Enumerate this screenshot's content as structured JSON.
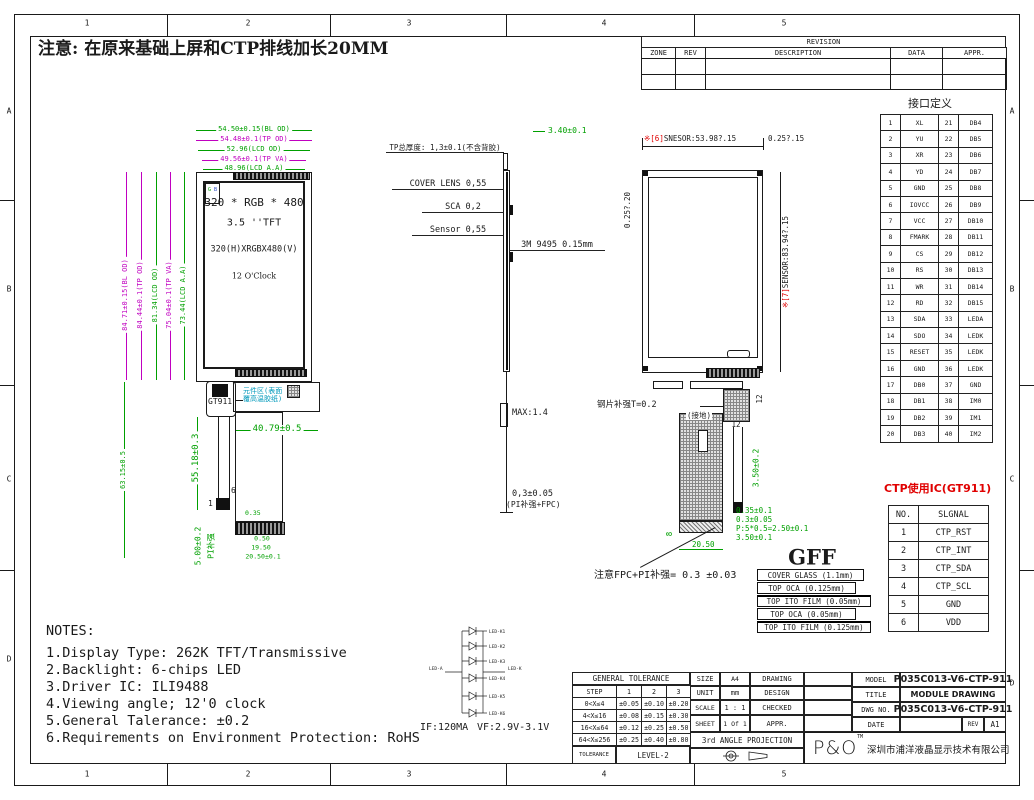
{
  "border": {
    "cols": [
      "1",
      "2",
      "3",
      "4",
      "5"
    ],
    "rows": [
      "A",
      "B",
      "C",
      "D"
    ]
  },
  "top_note": "注意: 在原来基础上屏和CTP排线加长20MM",
  "revision": {
    "title": "REVISION",
    "headers": [
      [
        "ZONE",
        "REV",
        "DESCRIPTION",
        "DATA",
        "APPR."
      ]
    ]
  },
  "front": {
    "h_dims": [
      "54.50±0.15(BL OD)",
      "54.48±0.1(TP OD)",
      "52.96(LCD OD)",
      "49.56±0.1(TP VA)",
      "48.96(LCD A.A)"
    ],
    "v_dims": [
      "84.71±0.15(BL OD)",
      "84.44±0.1(TP OD)",
      "81.34(LCD OD)",
      "75.04±0.1(TP VA)",
      "73.44(LCD A.A)"
    ],
    "screen": [
      "320 * RGB * 480",
      "3.5 ''TFT",
      "320(H)XRGBX480(V)",
      "12 O'Clock"
    ],
    "corner_g": "G",
    "corner_b": "B",
    "chip": "GT911",
    "comp_note1": "元件区(表面",
    "comp_note2": "覆高温胶纸)",
    "dim_fpc_w": "40.79±0.5",
    "dim_tail": "55.18±0.3",
    "dim_total": "63.15±0.5",
    "dim_pi": "5.00±0.2",
    "pi_label": "PI补强",
    "pin_top": "6",
    "pin_bottom": "1",
    "d035": "0.35",
    "d050": "0.50",
    "d1950": "19.50",
    "d2050": "20.50±0.1"
  },
  "side": {
    "d340": "3.40±0.1",
    "tp_note": "TP总厚度: 1,3±0.1(不含背胶)",
    "l_cover": "COVER LENS 0,55",
    "l_sca": "SCA 0,2",
    "l_sensor": "Sensor 0,55",
    "l_3m": "3M 9495 0.15mm",
    "max": "MAX:1.4",
    "d03": "0,3±0.05",
    "d03b": "(PI补强+FPC)"
  },
  "back": {
    "mark6": "※[6]",
    "dim6": "SNESOR:53.98?.15",
    "d025r": "0.25?.15",
    "d025l": "0.25?.20",
    "mark7": "※[7]",
    "dim7": "SENSOR:83.94?.15",
    "steel": "钢片补强T=0.2",
    "ground": "(接地)",
    "d12v": "12",
    "d12h": "12",
    "d350a": "3.50±0.2",
    "d8": "8",
    "d2050": "20.50",
    "gdims": [
      "0.35±0.1",
      "0.3±0.05",
      "P:5*0.5=2.50±0.1",
      "3.50±0.1"
    ],
    "fpc_note": "注意FPC+PI补强= 0.3 ±0.03"
  },
  "pin_table": {
    "title": "接口定义",
    "rows": [
      [
        "1",
        "XL",
        "21",
        "DB4"
      ],
      [
        "2",
        "YU",
        "22",
        "DB5"
      ],
      [
        "3",
        "XR",
        "23",
        "DB6"
      ],
      [
        "4",
        "YD",
        "24",
        "DB7"
      ],
      [
        "5",
        "GND",
        "25",
        "DB8"
      ],
      [
        "6",
        "IOVCC",
        "26",
        "DB9"
      ],
      [
        "7",
        "VCC",
        "27",
        "DB10"
      ],
      [
        "8",
        "FMARK",
        "28",
        "DB11"
      ],
      [
        "9",
        "CS",
        "29",
        "DB12"
      ],
      [
        "10",
        "RS",
        "30",
        "DB13"
      ],
      [
        "11",
        "WR",
        "31",
        "DB14"
      ],
      [
        "12",
        "RD",
        "32",
        "DB15"
      ],
      [
        "13",
        "SDA",
        "33",
        "LEDA"
      ],
      [
        "14",
        "SDO",
        "34",
        "LEDK"
      ],
      [
        "15",
        "RESET",
        "35",
        "LEDK"
      ],
      [
        "16",
        "GND",
        "36",
        "LEDK"
      ],
      [
        "17",
        "DB0",
        "37",
        "GND"
      ],
      [
        "18",
        "DB1",
        "38",
        "IM0"
      ],
      [
        "19",
        "DB2",
        "39",
        "IM1"
      ],
      [
        "20",
        "DB3",
        "40",
        "IM2"
      ]
    ]
  },
  "ctp": {
    "title": "CTP使用IC(GT911)",
    "rows": [
      [
        "NO.",
        "SLGNAL"
      ],
      [
        "1",
        "CTP_RST"
      ],
      [
        "2",
        "CTP_INT"
      ],
      [
        "3",
        "CTP_SDA"
      ],
      [
        "4",
        "CTP_SCL"
      ],
      [
        "5",
        "GND"
      ],
      [
        "6",
        "VDD"
      ]
    ]
  },
  "gff": {
    "title": "GFF",
    "layers": [
      "COVER GLASS (1.1mm)",
      "TOP OCA (0.125mm)",
      "TOP ITO FILM (0.05mm)",
      "TOP OCA (0.05mm)",
      "TOP ITO FILM (0.125mm)"
    ]
  },
  "notes": {
    "title": "NOTES:",
    "items": [
      "1.Display Type: 262K TFT/Transmissive",
      "2.Backlight: 6-chips LED",
      "3.Driver IC: ILI9488",
      "4.Viewing angle; 12'0 clock",
      "5.General Talerance: ±0.2",
      "6.Requirements on Environment Protection: RoHS"
    ]
  },
  "led": {
    "anode": "LED-A",
    "cathode": "LED-K",
    "ks": [
      "LED-K1",
      "LED-K2",
      "LED-K3",
      "LED-K4",
      "LED-K5",
      "LED-K6"
    ],
    "if_spec": "IF:120MA",
    "vf_spec": "VF:2.9V-3.1V"
  },
  "tol": {
    "title": "GENERAL TOLERANCE",
    "rows": [
      [
        "STEP",
        "1",
        "2",
        "3"
      ],
      [
        "0<X≤4",
        "±0.05",
        "±0.10",
        "±0.20"
      ],
      [
        "4<X≤16",
        "±0.08",
        "±0.15",
        "±0.30"
      ],
      [
        "16<X≤64",
        "±0.12",
        "±0.25",
        "±0.50"
      ],
      [
        "64<X≤256",
        "±0.25",
        "±0.40",
        "±0.80"
      ]
    ],
    "footer_label": "TOLERANCE",
    "footer_value": "LEVEL-2"
  },
  "info": {
    "size_label": "SIZE",
    "size": "A4",
    "unit_label": "UNIT",
    "unit": "mm",
    "scale_label": "SCALE",
    "scale": "1 : 1",
    "sheet_label": "SHEET",
    "sheet": "1 Of 1",
    "projection": "3rd ANGLE PROJECTION"
  },
  "sign": {
    "drawing": "DRAWING",
    "design": "DESIGN",
    "checked": "CHECKED",
    "appr": "APPR."
  },
  "doc": {
    "model_label": "MODEL",
    "model": "P035C013-V6-CTP-911",
    "title_label": "TITLE",
    "title": "MODULE DRAWING",
    "dwg_label": "DWG NO.",
    "dwg": "P035C013-V6-CTP-911",
    "date_label": "DATE",
    "rev_label": "REV",
    "rev": "A1"
  },
  "brand": {
    "logo": "P&O",
    "tm": "TM",
    "company": "深圳市浦洋液晶显示技术有限公司"
  }
}
